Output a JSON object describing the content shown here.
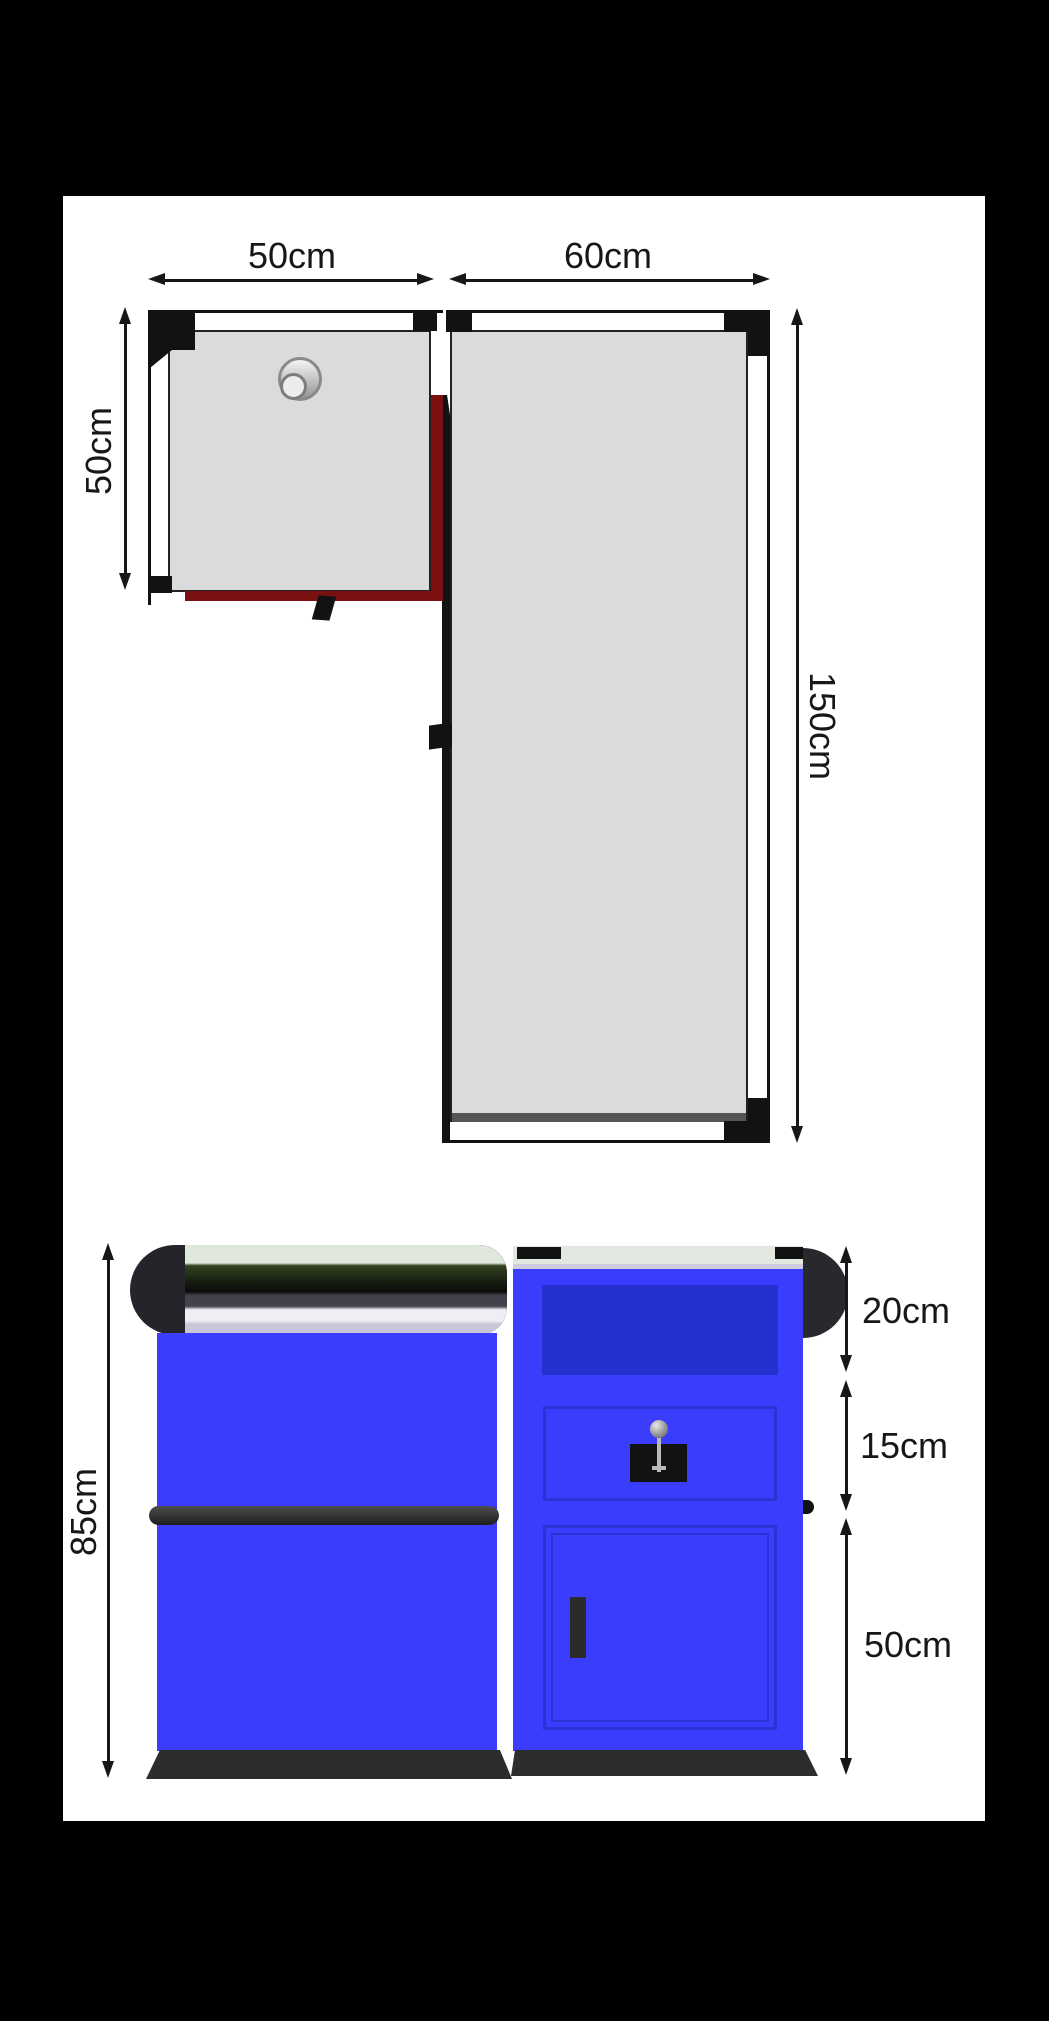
{
  "title": "Corner workbench dimension diagram",
  "top_view": {
    "left_width_label": "50cm",
    "right_width_label": "60cm",
    "left_depth_label": "50cm",
    "right_length_label": "150cm"
  },
  "front_view": {
    "total_height_label": "85cm",
    "top_section_label": "20cm",
    "middle_section_label": "15cm",
    "bottom_section_label": "50cm"
  },
  "colors": {
    "black": "#000000",
    "white": "#ffffff",
    "line": "#171717",
    "gray": "#dbdbdb",
    "red": "#7a1010",
    "blue": "#3a3dfb",
    "blue_dark": "#2531cf",
    "blue_line": "#2c33d4",
    "dark": "#2d2d30",
    "sage": "#e0e7db",
    "purple_gray": "#45414c",
    "lavender": "#efeef5",
    "lavender_mid": "#c8c6d9",
    "strip_gray": "#e2e7e0",
    "strip_lavender": "#cfcdde"
  }
}
